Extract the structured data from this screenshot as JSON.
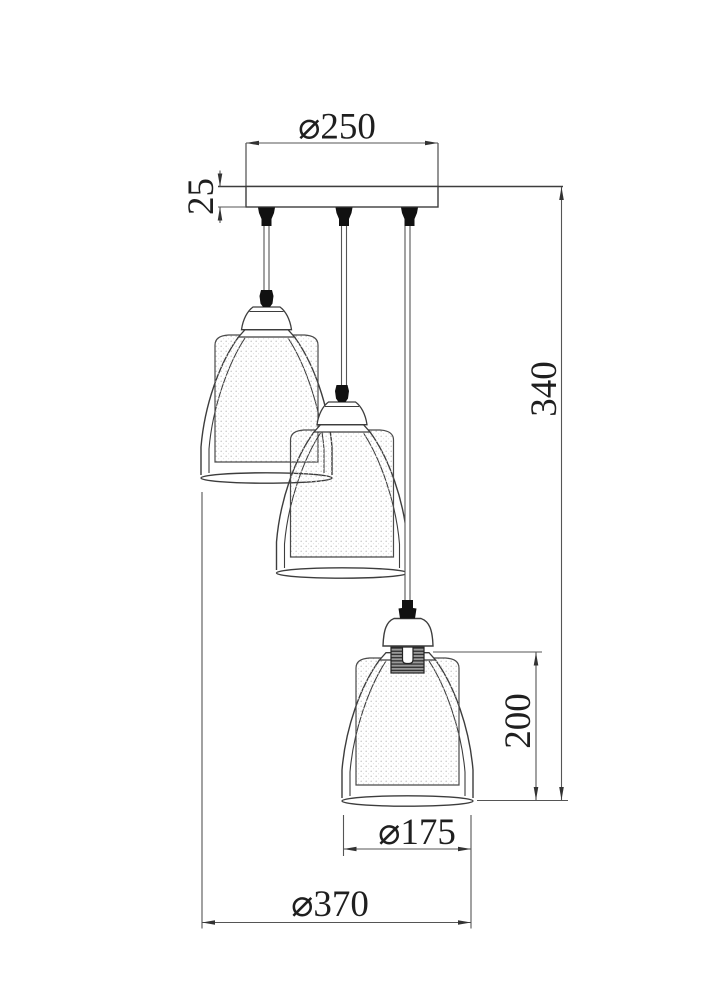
{
  "drawing": {
    "kind": "three-light-cluster-pendant-dimension-drawing",
    "dimensions": {
      "canopy_diameter": {
        "label": "⌀250",
        "value": 250
      },
      "canopy_thickness": {
        "label": "25",
        "value": 25
      },
      "drop_height": {
        "label": "340",
        "value": 340
      },
      "shade_height": {
        "label": "200",
        "value": 200
      },
      "shade_diameter": {
        "label": "⌀175",
        "value": 175
      },
      "overall_width": {
        "label": "⌀370",
        "value": 370
      }
    },
    "colors": {
      "object_line": "#3d3d3d",
      "dimension_line": "#555555",
      "text": "#1f1f1f",
      "socket_black": "#111111",
      "thread_block": "#9a9a9a"
    }
  }
}
